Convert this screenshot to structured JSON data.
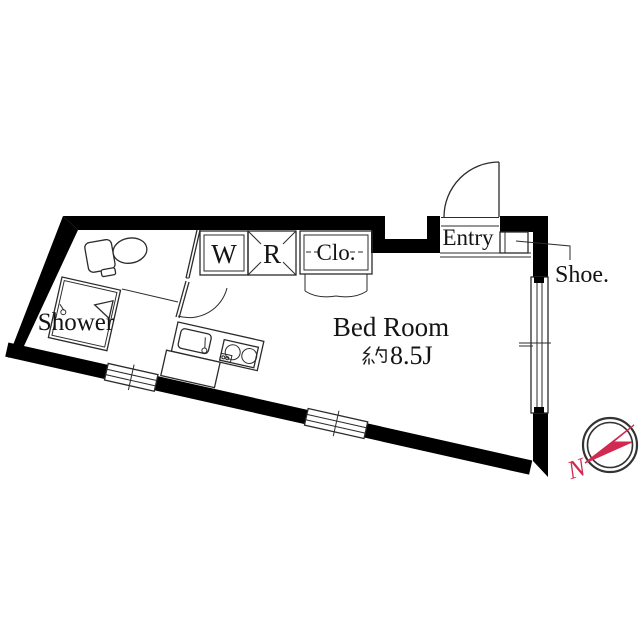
{
  "page": {
    "background": "#ffffff",
    "type_hint": "apartment floor plan"
  },
  "plan": {
    "rooms": {
      "shower_label": "Shower",
      "washer_label": "W",
      "refrigerator_label": "R",
      "closet_label": "Clo.",
      "entry_label": "Entry",
      "shoe_label": "Shoe.",
      "bedroom_label": "Bed Room",
      "bedroom_area_prefix": "約",
      "bedroom_area_value": "8.5J",
      "bedroom_area_full": "約8.5J"
    },
    "compass": {
      "north_label": "N"
    },
    "colors": {
      "wall": "#000000",
      "line": "#2b2b2b",
      "compass_red": "#d22950",
      "background": "#ffffff"
    }
  }
}
